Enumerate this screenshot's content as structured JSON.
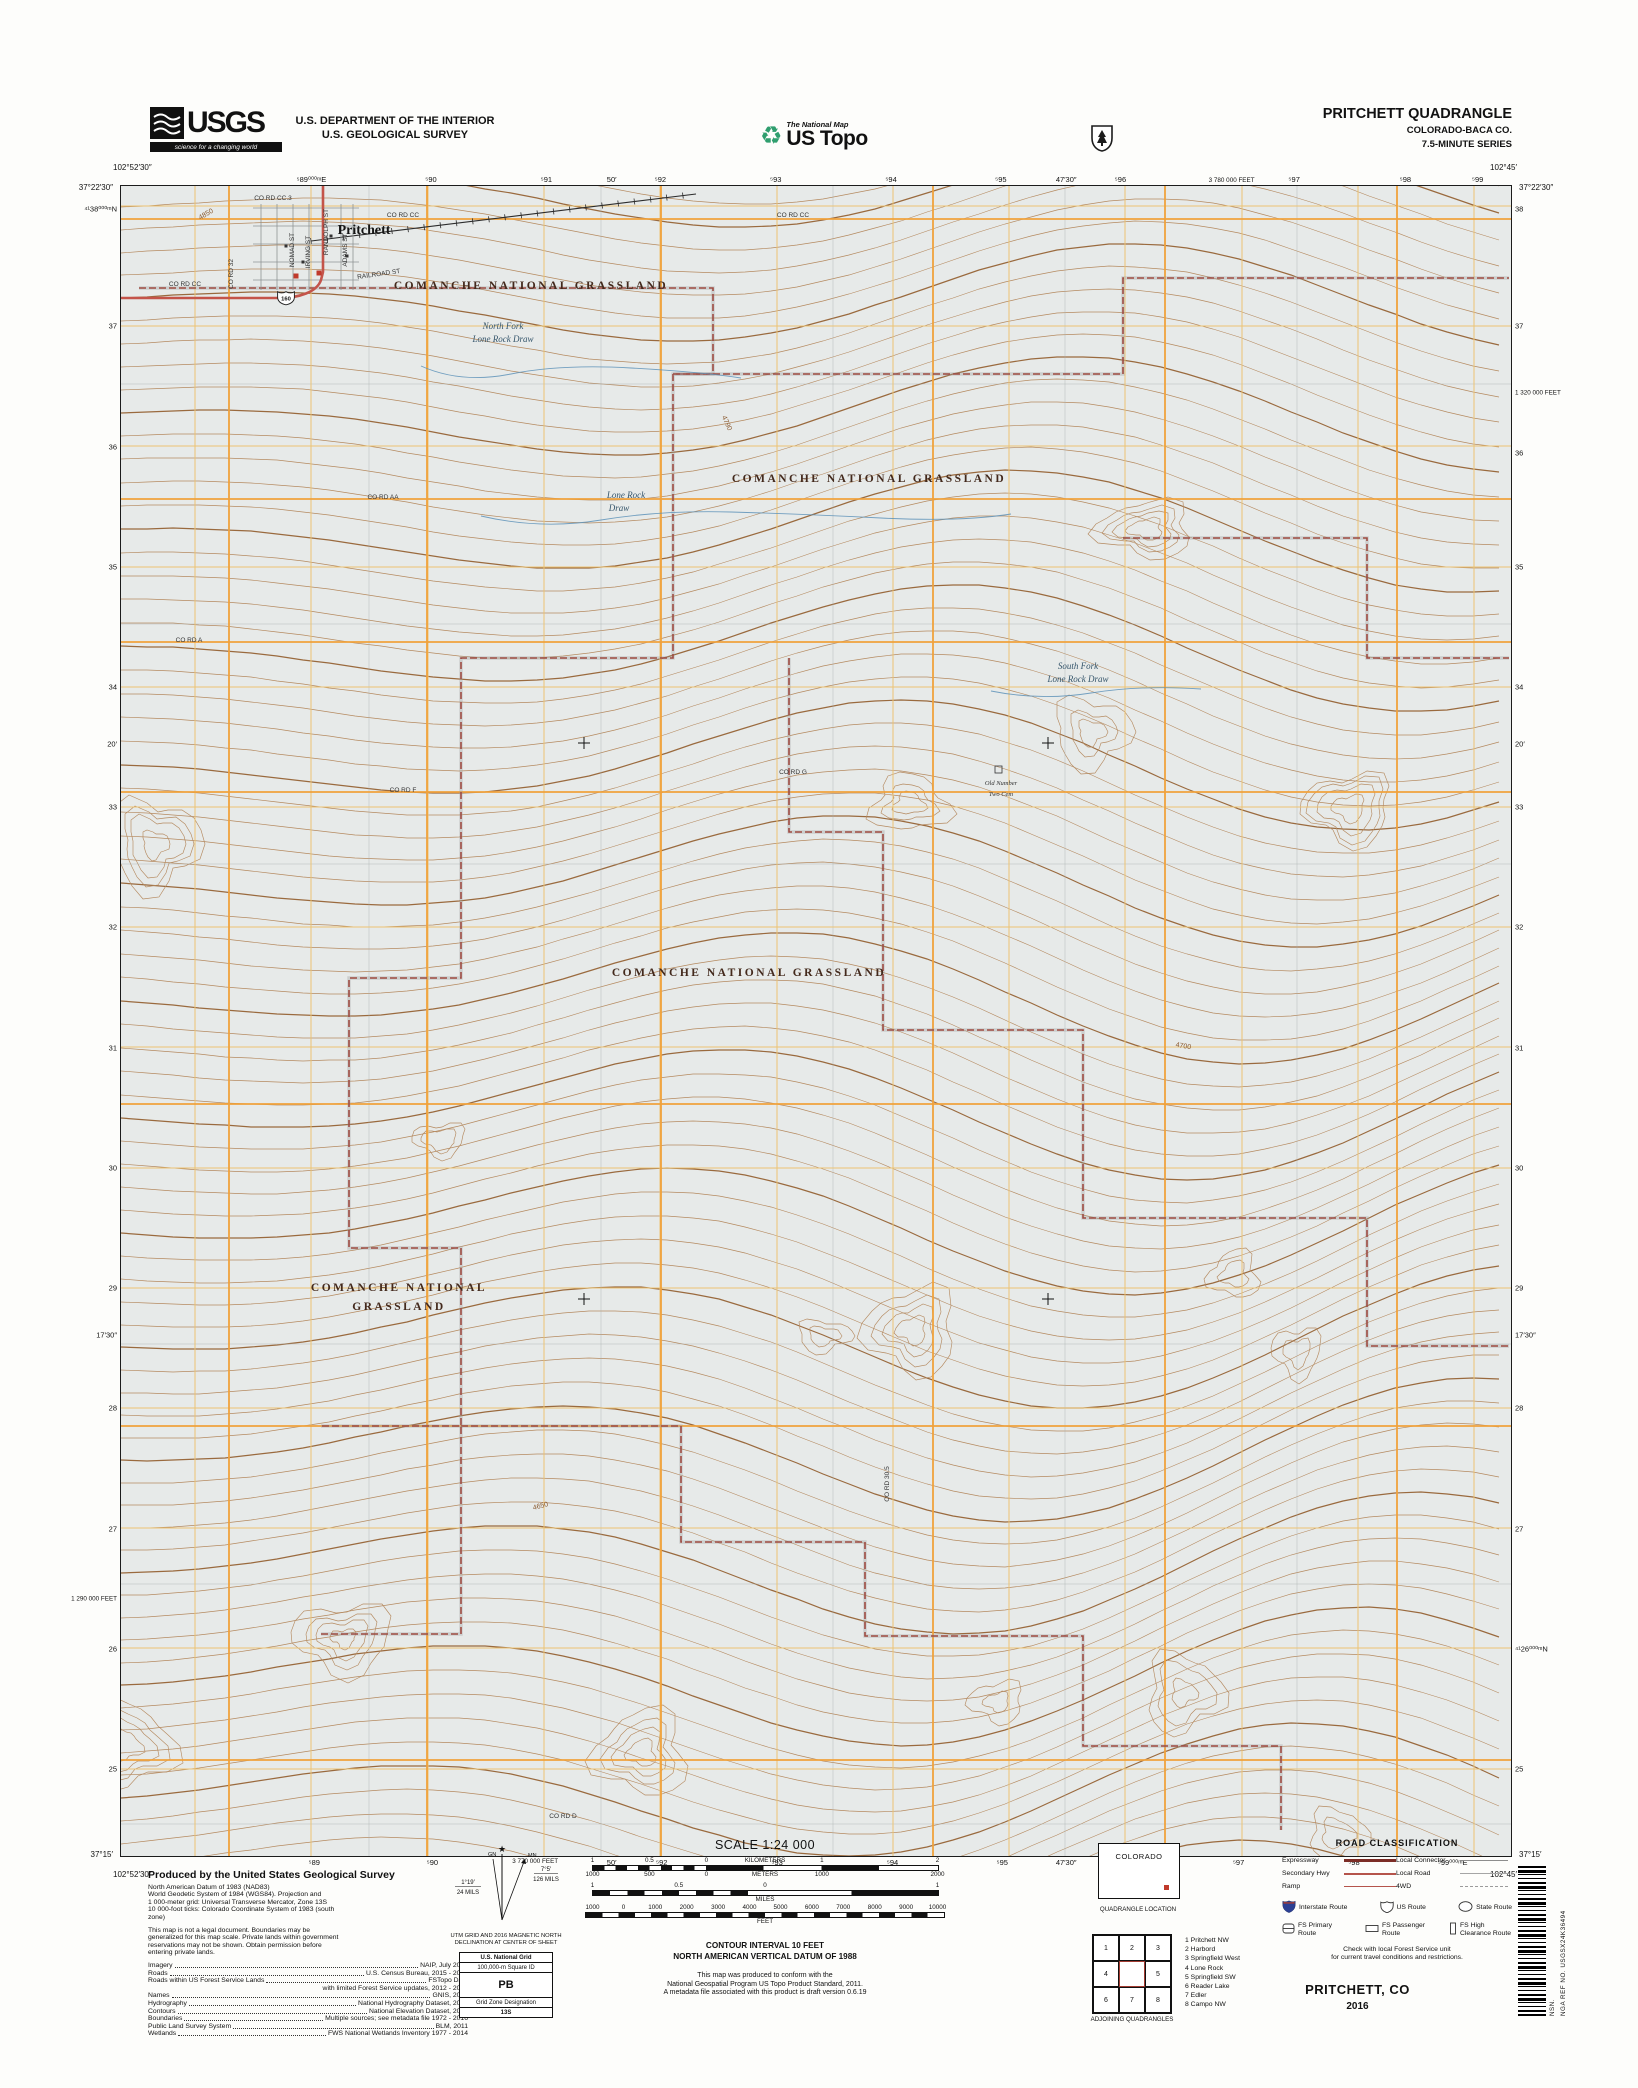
{
  "colors": {
    "map_bg": "#e7eae9",
    "contour": "#b58a60",
    "contour_index": "#9a6a3e",
    "utm_grid": "#ecc372",
    "road_orange": "#f0a23c",
    "boundary": "#9e4b42",
    "road_red": "#c4544a",
    "water": "#5d92b8"
  },
  "header": {
    "agency_logo": "USGS",
    "agency_tagline": "science for a changing world",
    "dept_line1": "U.S. DEPARTMENT OF THE INTERIOR",
    "dept_line2": "U.S. GEOLOGICAL SURVEY",
    "program_small": "The National Map",
    "program_large": "US Topo",
    "recycle_icon": "♻",
    "quad_title": "PRITCHETT QUADRANGLE",
    "quad_state": "COLORADO-BACA CO.",
    "quad_series": "7.5-MINUTE SERIES"
  },
  "map": {
    "corners": {
      "tl_lon": "102°52′30″",
      "tl_lat": "37°22′30″",
      "tr_lon": "102°45′",
      "tr_lat": "37°22′30″",
      "bl_lat": "37°15′",
      "bl_lon": "102°52′30″",
      "br_lat": "37°15′",
      "br_lon": "102°45′"
    },
    "edge_top": [
      {
        "t": "⁵89⁰⁰⁰ᵐE",
        "p": 13.7
      },
      {
        "t": "⁵90",
        "p": 22.3
      },
      {
        "t": "⁵91",
        "p": 30.6
      },
      {
        "t": "50′",
        "p": 35.3
      },
      {
        "t": "⁵92",
        "p": 38.8
      },
      {
        "t": "⁵93",
        "p": 47.1
      },
      {
        "t": "⁵94",
        "p": 55.4
      },
      {
        "t": "⁵95",
        "p": 63.3
      },
      {
        "t": "47′30″",
        "p": 68.0
      },
      {
        "t": "⁵96",
        "p": 71.9
      },
      {
        "t": "3 780 000 FEET",
        "p": 79.9
      },
      {
        "t": "⁵97",
        "p": 84.4
      },
      {
        "t": "⁵98",
        "p": 92.4
      },
      {
        "t": "⁵99",
        "p": 97.6
      }
    ],
    "edge_bottom": [
      {
        "t": "⁵89",
        "p": 13.9
      },
      {
        "t": "⁵90",
        "p": 22.4
      },
      {
        "t": "3 770 000 FEET",
        "p": 29.8
      },
      {
        "t": "50′",
        "p": 35.3
      },
      {
        "t": "⁵92",
        "p": 38.9
      },
      {
        "t": "⁵93",
        "p": 47.2
      },
      {
        "t": "⁵94",
        "p": 55.5
      },
      {
        "t": "⁵95",
        "p": 63.4
      },
      {
        "t": "47′30″",
        "p": 68.0
      },
      {
        "t": "⁵96",
        "p": 72.0
      },
      {
        "t": "⁵97",
        "p": 80.4
      },
      {
        "t": "⁵98",
        "p": 88.7
      },
      {
        "t": "⁵99⁰⁰⁰ᵐE",
        "p": 95.8
      }
    ],
    "edge_left": [
      {
        "t": "⁴¹38⁰⁰⁰ᵐN",
        "p": 1.4
      },
      {
        "t": "37",
        "p": 8.4
      },
      {
        "t": "36",
        "p": 15.6
      },
      {
        "t": "35",
        "p": 22.8
      },
      {
        "t": "34",
        "p": 30.0
      },
      {
        "t": "20′",
        "p": 33.4
      },
      {
        "t": "33",
        "p": 37.2
      },
      {
        "t": "32",
        "p": 44.4
      },
      {
        "t": "31",
        "p": 51.6
      },
      {
        "t": "30",
        "p": 58.8
      },
      {
        "t": "29",
        "p": 66.0
      },
      {
        "t": "17′30″",
        "p": 68.8
      },
      {
        "t": "28",
        "p": 73.2
      },
      {
        "t": "27",
        "p": 80.4
      },
      {
        "t": "1 290 000 FEET",
        "p": 84.6
      },
      {
        "t": "26",
        "p": 87.6
      },
      {
        "t": "25",
        "p": 94.8
      }
    ],
    "edge_right": [
      {
        "t": "38",
        "p": 1.4
      },
      {
        "t": "37",
        "p": 8.4
      },
      {
        "t": "1 320 000 FEET",
        "p": 12.4
      },
      {
        "t": "36",
        "p": 16.0
      },
      {
        "t": "35",
        "p": 22.8
      },
      {
        "t": "34",
        "p": 30.0
      },
      {
        "t": "20′",
        "p": 33.4
      },
      {
        "t": "33",
        "p": 37.2
      },
      {
        "t": "32",
        "p": 44.4
      },
      {
        "t": "31",
        "p": 51.6
      },
      {
        "t": "30",
        "p": 58.8
      },
      {
        "t": "29",
        "p": 66.0
      },
      {
        "t": "17′30″",
        "p": 68.8
      },
      {
        "t": "28",
        "p": 73.2
      },
      {
        "t": "27",
        "p": 80.4
      },
      {
        "t": "⁴¹26⁰⁰⁰ᵐN",
        "p": 87.6
      },
      {
        "t": "25",
        "p": 94.8
      }
    ],
    "labels": [
      {
        "t": "COMANCHE NATIONAL GRASSLAND",
        "x": 410,
        "y": 103,
        "c": "grass"
      },
      {
        "t": "COMANCHE NATIONAL GRASSLAND",
        "x": 748,
        "y": 296,
        "c": "grass"
      },
      {
        "t": "COMANCHE NATIONAL GRASSLAND",
        "x": 628,
        "y": 790,
        "c": "grass"
      },
      {
        "t": "COMANCHE NATIONAL",
        "x": 278,
        "y": 1105,
        "c": "grass"
      },
      {
        "t": "GRASSLAND",
        "x": 278,
        "y": 1124,
        "c": "grass"
      },
      {
        "t": "North Fork",
        "x": 382,
        "y": 143,
        "c": "stream"
      },
      {
        "t": "Lone Rock Draw",
        "x": 382,
        "y": 156,
        "c": "stream"
      },
      {
        "t": "Lone Rock",
        "x": 505,
        "y": 312,
        "c": "stream"
      },
      {
        "t": "Draw",
        "x": 498,
        "y": 325,
        "c": "stream"
      },
      {
        "t": "South Fork",
        "x": 957,
        "y": 483,
        "c": "stream"
      },
      {
        "t": "Lone Rock Draw",
        "x": 957,
        "y": 496,
        "c": "stream"
      },
      {
        "t": "Old Number",
        "x": 880,
        "y": 599,
        "c": "cem"
      },
      {
        "t": "Two Cem",
        "x": 880,
        "y": 610,
        "c": "cem"
      },
      {
        "t": "Pritchett",
        "x": 243,
        "y": 48,
        "c": "town"
      },
      {
        "t": "CO RD CC.3",
        "x": 152,
        "y": 14,
        "c": "road"
      },
      {
        "t": "CO RD CC",
        "x": 64,
        "y": 100,
        "c": "road"
      },
      {
        "t": "CO RD CC",
        "x": 282,
        "y": 31,
        "c": "road"
      },
      {
        "t": "CO RD CC",
        "x": 672,
        "y": 31,
        "c": "road"
      },
      {
        "t": "CO RD AA",
        "x": 262,
        "y": 313,
        "c": "road"
      },
      {
        "t": "CO RD A",
        "x": 68,
        "y": 456,
        "c": "road"
      },
      {
        "t": "CO RD F",
        "x": 282,
        "y": 606,
        "c": "road"
      },
      {
        "t": "CO RD G",
        "x": 672,
        "y": 588,
        "c": "road"
      },
      {
        "t": "CO RD D",
        "x": 442,
        "y": 1632,
        "c": "road"
      },
      {
        "t": "CO RD 32",
        "x": 112,
        "y": 88,
        "c": "vroad"
      },
      {
        "t": "CO RD 30.5",
        "x": 768,
        "y": 1298,
        "c": "vroad"
      },
      {
        "t": "RANDOLPH ST",
        "x": 207,
        "y": 46,
        "c": "vroad"
      },
      {
        "t": "NOMAD ST",
        "x": 173,
        "y": 64,
        "c": "vroad"
      },
      {
        "t": "IRVING ST",
        "x": 189,
        "y": 66,
        "c": "vroad"
      },
      {
        "t": "ADAMS ST",
        "x": 226,
        "y": 64,
        "c": "vroad"
      },
      {
        "t": "RAILROAD ST",
        "x": 258,
        "y": 90,
        "c": "road",
        "r": -8
      },
      {
        "t": "4850",
        "x": 86,
        "y": 30,
        "c": "elev",
        "r": -30
      },
      {
        "t": "4790",
        "x": 604,
        "y": 238,
        "c": "elev",
        "r": 65
      },
      {
        "t": "4700",
        "x": 1062,
        "y": 862,
        "c": "elev",
        "r": 10
      },
      {
        "t": "4650",
        "x": 420,
        "y": 1322,
        "c": "elev",
        "r": -15
      }
    ],
    "boundaries": [
      "M18,102 H592 V188 H552 V472 H340 V792 H228 V1062 H340 V1240 H200",
      "M552,188 H1002 V92 H1388",
      "M1002,352 H1246 V472 H1388",
      "M668,472 V646 H762 V844 H962 V1032 H1246 V1160 H1388",
      "M340,1240 H560 V1356 H744 V1450 H962 V1560 H1160 V1644",
      "M200,1448 H340 V1240"
    ],
    "crosses": [
      [
        463,
        557
      ],
      [
        927,
        557
      ],
      [
        463,
        1113
      ],
      [
        927,
        1113
      ]
    ],
    "route_shield": "160"
  },
  "credits": {
    "heading": "Produced by the United States Geological Survey",
    "datum_lines": [
      "North American Datum of 1983 (NAD83)",
      "World Geodetic System of 1984 (WGS84).  Projection and",
      "1 000-meter grid: Universal Transverse Mercator, Zone 13S",
      "10 000-foot ticks: Colorado Coordinate System of 1983 (south",
      "zone)"
    ],
    "legal_lines": [
      "This map is not a legal document. Boundaries may be",
      "generalized for this map scale. Private lands within government",
      "reservations may not be shown. Obtain permission before",
      "entering private lands."
    ],
    "sources": [
      {
        "label": "Imagery",
        "value": "NAIP, July 2013"
      },
      {
        "label": "Roads",
        "value": "U.S. Census Bureau, 2015 - 2016"
      },
      {
        "label": "Roads within US Forest Service Lands",
        "value": "FSTopo Data"
      },
      {
        "label": "",
        "value": "with limited Forest Service updates, 2012 - 2016"
      },
      {
        "label": "Names",
        "value": "GNIS, 2016"
      },
      {
        "label": "Hydrography",
        "value": "National Hydrography Dataset, 2013"
      },
      {
        "label": "Contours",
        "value": "National Elevation Dataset, 2006"
      },
      {
        "label": "Boundaries",
        "value": "Multiple sources; see metadata file 1972 - 2016"
      },
      {
        "label": "Public Land Survey System",
        "value": "BLM, 2011"
      },
      {
        "label": "Wetlands",
        "value": "FWS National Wetlands Inventory 1977 - 2014"
      }
    ]
  },
  "declination": {
    "true_north": "★",
    "gn_label": "GN",
    "mn_label": "MN",
    "gn_deg": "1°19′",
    "gn_mils": "24 MILS",
    "mn_deg": "7°5′",
    "mn_mils": "126 MILS",
    "caption1": "UTM GRID AND 2016 MAGNETIC NORTH",
    "caption2": "DECLINATION AT CENTER OF SHEET",
    "usng_title": "U.S. National Grid",
    "usng_sub": "100,000-m Square ID",
    "usng_square": "PB",
    "usng_zone_label": "Grid Zone Designation",
    "usng_zone": "13S"
  },
  "scale": {
    "title": "SCALE 1:24 000",
    "km_labels": [
      {
        "t": "1",
        "p": 0
      },
      {
        "t": "0.5",
        "p": 16.5
      },
      {
        "t": "0",
        "p": 33
      },
      {
        "t": "KILOMETERS",
        "p": 50
      },
      {
        "t": "1",
        "p": 66.5
      },
      {
        "t": "2",
        "p": 100
      }
    ],
    "m_labels": [
      {
        "t": "1000",
        "p": 0
      },
      {
        "t": "500",
        "p": 16.5
      },
      {
        "t": "0",
        "p": 33
      },
      {
        "t": "METERS",
        "p": 50
      },
      {
        "t": "1000",
        "p": 66.5
      },
      {
        "t": "2000",
        "p": 100
      }
    ],
    "mi_labels": [
      {
        "t": "1",
        "p": 0
      },
      {
        "t": "0.5",
        "p": 25
      },
      {
        "t": "0",
        "p": 50
      },
      {
        "t": "1",
        "p": 100
      }
    ],
    "miles_word": "MILES",
    "ft_labels": [
      {
        "t": "1000",
        "p": 0
      },
      {
        "t": "0",
        "p": 9
      },
      {
        "t": "1000",
        "p": 18.2
      },
      {
        "t": "2000",
        "p": 27.3
      },
      {
        "t": "3000",
        "p": 36.4
      },
      {
        "t": "4000",
        "p": 45.5
      },
      {
        "t": "5000",
        "p": 54.5
      },
      {
        "t": "6000",
        "p": 63.6
      },
      {
        "t": "7000",
        "p": 72.7
      },
      {
        "t": "8000",
        "p": 81.8
      },
      {
        "t": "9000",
        "p": 90.9
      },
      {
        "t": "10000",
        "p": 100
      }
    ],
    "feet_word": "FEET",
    "contour_line1": "CONTOUR INTERVAL 10 FEET",
    "contour_line2": "NORTH AMERICAN VERTICAL DATUM OF 1988",
    "conform_lines": [
      "This map was produced to conform with the",
      "National Geospatial Program US Topo Product Standard, 2011.",
      "A metadata file associated with this product is draft version 0.6.19"
    ]
  },
  "location": {
    "state_name": "COLORADO",
    "caption": "QUADRANGLE LOCATION",
    "adjoining_caption": "ADJOINING QUADRANGLES",
    "grid_numbers": [
      "1",
      "2",
      "3",
      "4",
      "",
      "5",
      "6",
      "7",
      "8"
    ],
    "quads": [
      "1 Pritchett NW",
      "2 Harbord",
      "3 Springfield West",
      "4 Lone Rock",
      "5 Springfield SW",
      "6 Reader Lake",
      "7 Edler",
      "8 Campo NW"
    ]
  },
  "road_class": {
    "title": "ROAD CLASSIFICATION",
    "rows": [
      {
        "label": "Expressway",
        "style": "expressway",
        "label2": "Local Connector",
        "style2": "local-connector"
      },
      {
        "label": "Secondary Hwy",
        "style": "secondary",
        "label2": "Local Road",
        "style2": "local-road"
      },
      {
        "label": "Ramp",
        "style": "ramp",
        "label2": "4WD",
        "style2": "fourwd"
      }
    ],
    "shields": [
      {
        "type": "interstate",
        "label": "Interstate Route"
      },
      {
        "type": "us",
        "label": "US Route"
      },
      {
        "type": "state",
        "label": "State Route"
      }
    ],
    "fs_routes": [
      {
        "type": "fs-primary",
        "label": "FS Primary Route"
      },
      {
        "type": "fs-passenger",
        "label": "FS Passenger Route"
      },
      {
        "type": "fs-high",
        "label": "FS High Clearance Route"
      }
    ],
    "note1": "Check with local Forest Service unit",
    "note2": "for current travel conditions and restrictions."
  },
  "footer_title": {
    "name": "PRITCHETT, CO",
    "year": "2016"
  },
  "sidebar": {
    "nsn": "NSN.",
    "nga_ref": "NGA REF NO. USGSX24K36494"
  }
}
